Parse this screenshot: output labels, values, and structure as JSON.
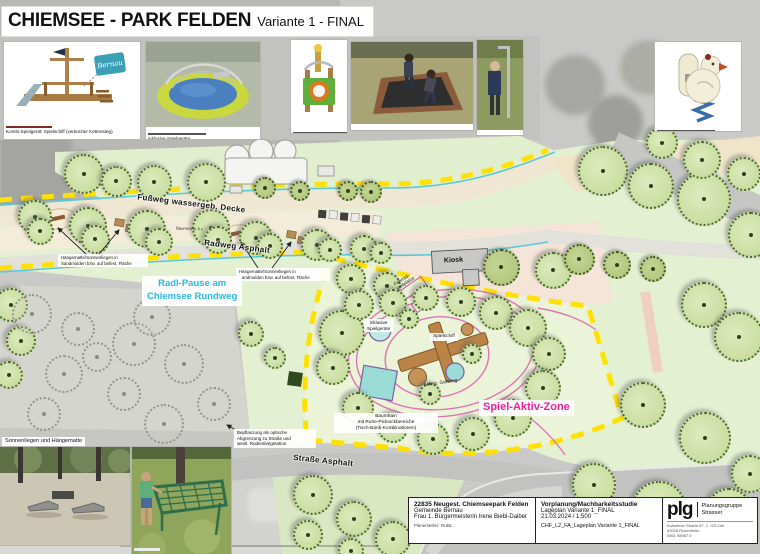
{
  "title": {
    "main": "CHIEMSEE - PARK FELDEN",
    "variant": "Variante 1 - FINAL"
  },
  "photo_strip": {
    "ship_badge": "Bernau",
    "ship_caption": "Kombi-Spielgerät: Spielschiff (verkürzter Kettensteg)",
    "inclusive_caption": "inklusive Spielgeräte"
  },
  "plan_labels": {
    "fussweg": "Fußweg wassergeb. Decke",
    "radweg": "Radweg Asphalt",
    "baumreihe": "Baumreihe 4 x",
    "haengematte": "Hängematte/Sonnenliegen in\nSandmulden bzw. auf befest. Fläche",
    "radl_pause": "Radl-Pause am\nChiemsee Rundweg",
    "kiosk": "Kiosk",
    "fahrrad": "Fahrrad-\nstellplätze",
    "inklusive": "inklusive\nSpielgeräte",
    "spielschiff": "Spielschiff",
    "gehweg": "befest. Gehweg",
    "baumhain": "Baumhain\nmit Ruhe-Picknickbereiche\n(Tisch-Bank-Kombinationen)",
    "bepflanzung": "Bepflanzung als optische\nAbgrenzung zu Straße und\nwestl. Ruderalvegetation",
    "strasse": "Straße Asphalt",
    "spiel_aktiv": "Spiel-Aktiv-Zone",
    "sonnenliegen": "Sonnenliegen und Hängematte"
  },
  "title_block": {
    "project": "22835 Neugest. Chiemseepark Felden",
    "client1": "Gemeinde Bernau",
    "client2": "Frau 1. Bürgermeisterin Irene Biebl-Daiber",
    "planner": "Planersteller: RUBL",
    "phase": "Vorplanung/Machbarkeitsstudie",
    "sheet": "Lageplan Variante 1_FINAL",
    "date_scale": "21.03.2024 / 1:500",
    "file": "CHF_L2_FA_Lageplan Variante 1_FINAL",
    "logo": "plg",
    "firm": "Planungsgruppe\nStrasser",
    "address": "Kufsteiner Straße 87, 1. OG-Ost\n83026 Rosenheim\n0861 98987 0"
  },
  "colors": {
    "accent_cyan": "#29b9dd",
    "accent_magenta": "#ed1ea0",
    "dash_yellow": "#ffe100"
  }
}
